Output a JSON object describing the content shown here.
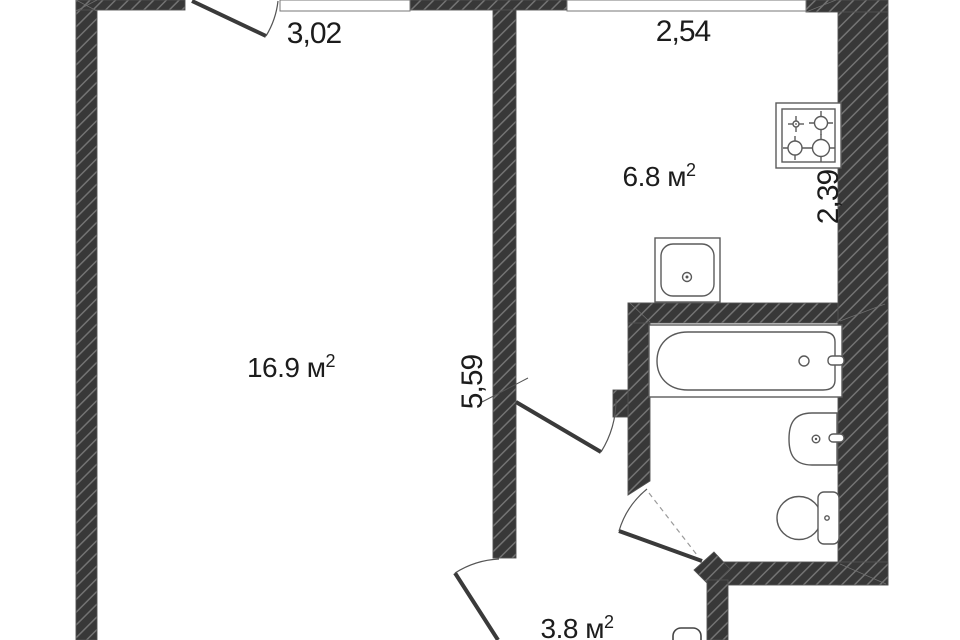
{
  "plan": {
    "title": "apartment-floor-plan",
    "rooms": [
      {
        "id": "living-room",
        "area_label": "16.9 м",
        "area_sup": "2"
      },
      {
        "id": "kitchen",
        "area_label": "6.8 м",
        "area_sup": "2"
      },
      {
        "id": "hallway",
        "area_label": "3.8 м",
        "area_sup": "2"
      }
    ],
    "dimensions": {
      "living_width": "3,02",
      "kitchen_width": "2,54",
      "kitchen_depth": "2,39",
      "living_depth": "5,59"
    },
    "fixtures": [
      "stove-icon",
      "kitchen-sink-icon",
      "bathtub-icon",
      "washbasin-icon",
      "toilet-icon"
    ],
    "colors": {
      "wall": "#383838",
      "hatch_line": "#828282",
      "outline": "#5a5a5a",
      "text": "#1c1c1c",
      "background": "#ffffff"
    }
  }
}
